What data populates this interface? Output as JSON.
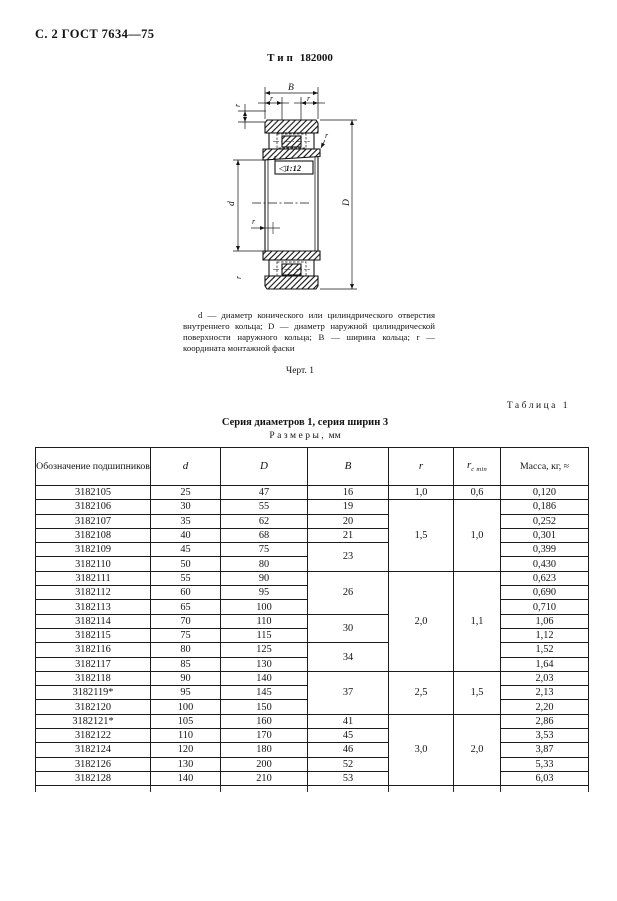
{
  "header": {
    "text": "С. 2 ГОСТ 7634—75"
  },
  "figure": {
    "type_word": "Тип",
    "type_number": "182000",
    "labels": {
      "B": "B",
      "r": "r",
      "d": "d",
      "D": "D",
      "taper": "◁1:12"
    },
    "caption": "d — диаметр конического или цилиндрического отверстия внутреннего кольца; D — диаметр наружной цилиндрической поверхности наружного кольца; B — ширина кольца; r — координата монтажной фаски",
    "figure_label": "Черт. 1"
  },
  "table": {
    "label": "Таблица 1",
    "title": "Серия диаметров 1, серия ширин 3",
    "subtitle_spaced": "Размеры,",
    "subtitle_unit": "мм",
    "columns": [
      {
        "label": "Обозначение подшипников"
      },
      {
        "label": "d"
      },
      {
        "label": "D"
      },
      {
        "label": "B"
      },
      {
        "label": "r"
      },
      {
        "label": "r",
        "sub": "с min"
      },
      {
        "label": "Масса, кг, ≈"
      }
    ],
    "rows": [
      {
        "des": "3182105",
        "d": "25",
        "D": "47",
        "B": {
          "v": "16",
          "span": 1
        },
        "r": {
          "v": "1,0",
          "span": 1
        },
        "r1": {
          "v": "0,6",
          "span": 1
        },
        "m": "0,120"
      },
      {
        "des": "3182106",
        "d": "30",
        "D": "55",
        "B": {
          "v": "19",
          "span": 1
        },
        "r": {
          "v": "1,5",
          "span": 5
        },
        "r1": {
          "v": "1,0",
          "span": 5
        },
        "m": "0,186"
      },
      {
        "des": "3182107",
        "d": "35",
        "D": "62",
        "B": {
          "v": "20",
          "span": 1
        },
        "m": "0,252"
      },
      {
        "des": "3182108",
        "d": "40",
        "D": "68",
        "B": {
          "v": "21",
          "span": 1
        },
        "m": "0,301"
      },
      {
        "des": "3182109",
        "d": "45",
        "D": "75",
        "B": {
          "v": "23",
          "span": 2
        },
        "m": "0,399"
      },
      {
        "des": "3182110",
        "d": "50",
        "D": "80",
        "m": "0,430"
      },
      {
        "des": "3182111",
        "d": "55",
        "D": "90",
        "B": {
          "v": "26",
          "span": 3
        },
        "r": {
          "v": "2,0",
          "span": 7
        },
        "r1": {
          "v": "1,1",
          "span": 7
        },
        "m": "0,623"
      },
      {
        "des": "3182112",
        "d": "60",
        "D": "95",
        "m": "0,690"
      },
      {
        "des": "3182113",
        "d": "65",
        "D": "100",
        "m": "0,710"
      },
      {
        "des": "3182114",
        "d": "70",
        "D": "110",
        "B": {
          "v": "30",
          "span": 2
        },
        "m": "1,06"
      },
      {
        "des": "3182115",
        "d": "75",
        "D": "115",
        "m": "1,12"
      },
      {
        "des": "3182116",
        "d": "80",
        "D": "125",
        "B": {
          "v": "34",
          "span": 2
        },
        "m": "1,52"
      },
      {
        "des": "3182117",
        "d": "85",
        "D": "130",
        "m": "1,64"
      },
      {
        "des": "3182118",
        "d": "90",
        "D": "140",
        "B": {
          "v": "37",
          "span": 3
        },
        "r": {
          "v": "2,5",
          "span": 3
        },
        "r1": {
          "v": "1,5",
          "span": 3
        },
        "m": "2,03"
      },
      {
        "des": "3182119*",
        "d": "95",
        "D": "145",
        "m": "2,13"
      },
      {
        "des": "3182120",
        "d": "100",
        "D": "150",
        "m": "2,20"
      },
      {
        "des": "3182121*",
        "d": "105",
        "D": "160",
        "B": {
          "v": "41",
          "span": 1
        },
        "r": {
          "v": "3,0",
          "span": 5
        },
        "r1": {
          "v": "2,0",
          "span": 5
        },
        "m": "2,86"
      },
      {
        "des": "3182122",
        "d": "110",
        "D": "170",
        "B": {
          "v": "45",
          "span": 1
        },
        "m": "3,53"
      },
      {
        "des": "3182124",
        "d": "120",
        "D": "180",
        "B": {
          "v": "46",
          "span": 1
        },
        "m": "3,87"
      },
      {
        "des": "3182126",
        "d": "130",
        "D": "200",
        "B": {
          "v": "52",
          "span": 1
        },
        "m": "5,33"
      },
      {
        "des": "3182128",
        "d": "140",
        "D": "210",
        "B": {
          "v": "53",
          "span": 1
        },
        "m": "6,03"
      }
    ]
  }
}
